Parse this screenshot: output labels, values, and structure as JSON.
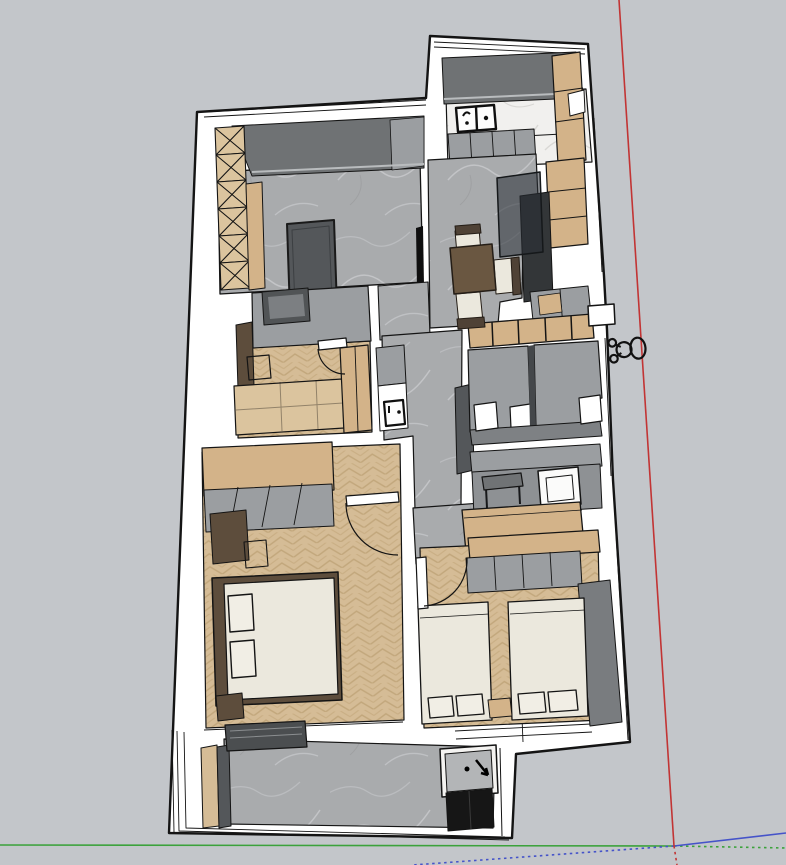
{
  "scene": {
    "app": "3d-model-viewport",
    "view": "top-down-perspective-floor-plan",
    "background_color": "#c3c6ca"
  },
  "palette": {
    "wall_white": "#ffffff",
    "outline": "#141414",
    "marble_gray": "#a9abad",
    "marble_vein": "#c9cbcd",
    "marble_white": "#f1f0ee",
    "marble_white_vein": "#d9d8d5",
    "wood_floor": "#d5bc96",
    "wood_chevron": "#c2a77c",
    "wood_cabinet": "#d3b389",
    "wood_light": "#dbc49e",
    "gray_cabinet": "#9b9ea1",
    "gray_dark": "#6f7274",
    "gray_deep": "#54575a",
    "gray_floor": "#8e9194",
    "gray_tile_floor": "#7e8184",
    "shadow_wall": "#797c7f",
    "brown_dark": "#5d4d3c",
    "brown_table": "#6a5741",
    "brown_chairback": "#4f4236",
    "cream": "#ebe8dd",
    "cream_pillow": "#f1eee5",
    "black_fixture": "#161616",
    "glass": "rgba(40,46,52,0.55)",
    "sill_light": "#b9bcbe",
    "drying_rack": "#4b4e50"
  },
  "axes": {
    "red_color": "#c23434",
    "green_color": "#3ba23b",
    "blue_color": "#4553c9",
    "origin": {
      "x": 674,
      "y": 846
    }
  },
  "model": {
    "rooms": [
      {
        "name": "living-room",
        "floor": "marble-gray"
      },
      {
        "name": "kitchen",
        "floor": "marble-white"
      },
      {
        "name": "dining-entry-hall",
        "floor": "marble-gray"
      },
      {
        "name": "study-bedroom",
        "floor": "wood-parquet"
      },
      {
        "name": "master-bedroom",
        "floor": "wood-parquet"
      },
      {
        "name": "kids-bedroom",
        "floor": "wood-parquet"
      },
      {
        "name": "bathroom",
        "floor": "gray-tile"
      },
      {
        "name": "laundry-room",
        "floor": "gray-tile"
      },
      {
        "name": "balcony",
        "floor": "marble-gray"
      }
    ],
    "figure": "scale-person-top-view"
  }
}
